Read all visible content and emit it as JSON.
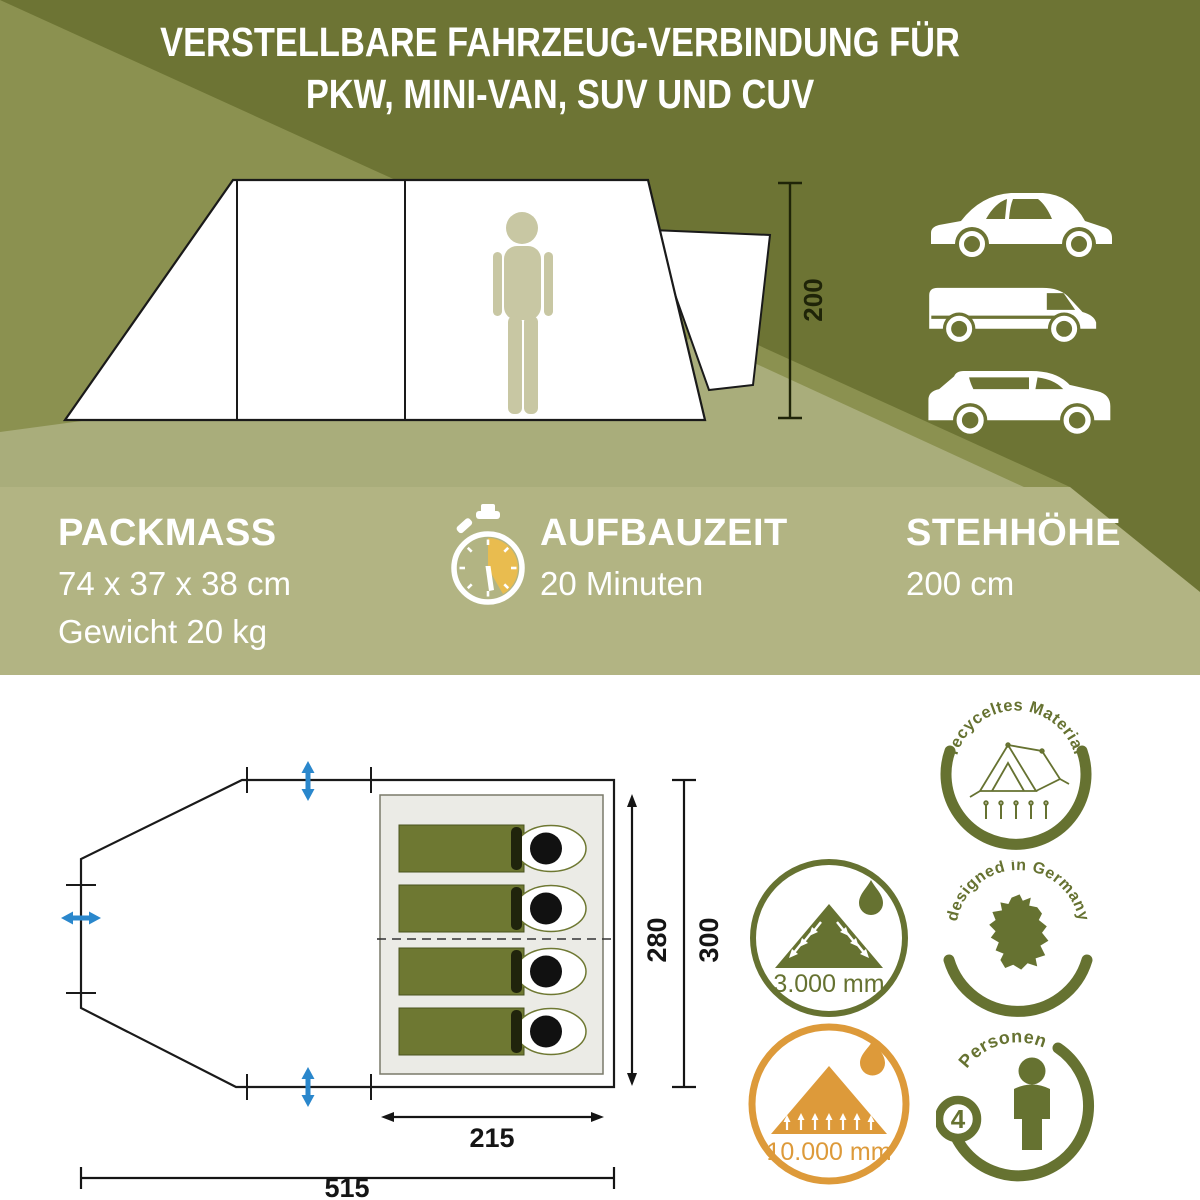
{
  "header": {
    "line1": "VERSTELLBARE FAHRZEUG-VERBINDUNG FÜR",
    "line2": "PKW, MINI-VAN, SUV UND CUV"
  },
  "side_view": {
    "height_label": "200",
    "vehicles": [
      "car",
      "mini-van",
      "suv"
    ]
  },
  "specs": {
    "packmass_title": "PACKMASS",
    "packmass_size": "74 x 37 x 38 cm",
    "packmass_weight": "Gewicht 20 kg",
    "aufbauzeit_title": "AUFBAUZEIT",
    "aufbauzeit_value": "20 Minuten",
    "stehhoehe_title": "STEHHÖHE",
    "stehhoehe_value": "200 cm"
  },
  "floor_plan": {
    "inner_width_label": "215",
    "inner_depth_label": "280",
    "outer_depth_label": "300",
    "length_label": "515",
    "sleeping_bag_count": 4
  },
  "badges": {
    "recycled_text": "recyceltes Material",
    "waterproof_fly_label": "3.000 mm",
    "designed_text": "designed in Germany",
    "waterproof_floor_label": "10.000 mm",
    "persons_text": "Personen",
    "persons_count": "4"
  },
  "colors": {
    "olive_dark": "#6d7434",
    "olive_medium": "#8b9150",
    "olive_light": "#a9ad7b",
    "strip": "#b2b483",
    "badge_olive": "#667231",
    "orange": "#dd9a3a",
    "blue": "#2a87cc",
    "bag_olive": "#6e7832",
    "person_beige": "#c8c7a3",
    "stopwatch_yellow": "#e9bc4f"
  }
}
